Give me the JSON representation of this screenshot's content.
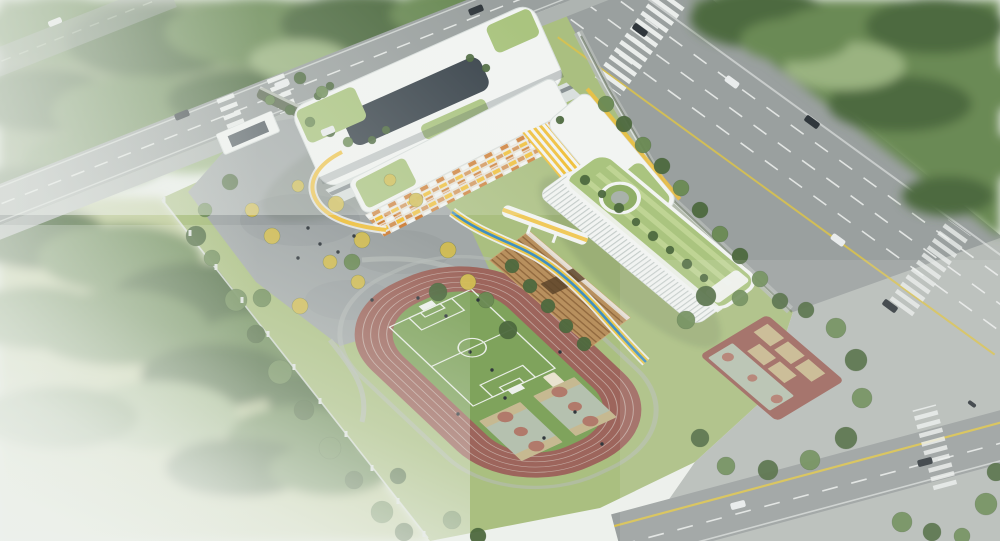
{
  "meta": {
    "title": "Aerial architectural rendering of a school campus",
    "image_type": "architectural bird's-eye render, no visible text",
    "regions": [
      "misty-forest-top-left",
      "urban-road-upper-left",
      "school-entrance-plaza-with-gate",
      "u-shaped-teaching-building",
      "classroom-slab-with-checkered-facade",
      "east-wing-yellow-louvers",
      "elevated-yellow-blue-walkway",
      "gymnasium-long-green-roof-with-circular-courtyard",
      "wood-grandstand-bleachers",
      "running-track-oval",
      "soccer-field",
      "basketball-courts-in-infield",
      "outdoor-courts-east",
      "main-arterial-road-right",
      "dense-forest-top-right",
      "foggy-forest-bottom-left",
      "intersection-and-pavement-bottom-right",
      "boundary-fence-with-posts"
    ]
  },
  "colors": {
    "mist": "#edf1ec",
    "forest_base": "#7b9465",
    "forest_dark": "#4e6a3f",
    "forest_mid": "#6b8a54",
    "forest_light": "#9ab380",
    "lawn": "#aabf80",
    "lawn_light": "#c3cf9e",
    "road": "#9aa09f",
    "pavement": "#b7bcb8",
    "sidewalk": "#aeb4b1",
    "lane_white": "#eef1ef",
    "lane_yellow": "#d8c14e",
    "plaza": "#a2a8a8",
    "plaza_dark": "#8b9294",
    "bldg_white": "#f2f4f2",
    "bldg_shade": "#d9dfdd",
    "bldg_dark": "#39434b",
    "accent_yellow": "#f0c13f",
    "accent_orange": "#d08440",
    "roof_green": "#8fae66",
    "roof_green_light": "#aac47f",
    "roof_stripe": "#bfd494",
    "track_red": "#9d655c",
    "track_line": "#d9cfc6",
    "field_green": "#7fa35c",
    "pitch_line": "#e9eee6",
    "court_gray": "#b5c1af",
    "court_terra": "#b17a6b",
    "court_tan": "#c8b88e",
    "bleacher": "#b8905e",
    "bleacher_line": "#8a6238",
    "ribbon_blue": "#3f8fc2",
    "ribbon_yellow": "#e9c64a",
    "tree_yellow": "#d2bd52",
    "car_dark": "#30373c",
    "car_white": "#e9ecec",
    "fence": "#dfe4e1",
    "hedge": "#5f6b55",
    "shed": "#e9e3cf",
    "shadow": "#4f5e49"
  },
  "scene": {
    "tree_legend": {
      "d": "forest_dark",
      "m": "forest_mid",
      "l": "forest_light",
      "y": "tree_yellow"
    },
    "trees": [
      [
        196,
        236,
        10,
        "d"
      ],
      [
        212,
        258,
        8,
        "m"
      ],
      [
        236,
        300,
        11,
        "m"
      ],
      [
        256,
        334,
        9,
        "d"
      ],
      [
        280,
        372,
        12,
        "m"
      ],
      [
        304,
        410,
        10,
        "d"
      ],
      [
        330,
        448,
        11,
        "m"
      ],
      [
        354,
        480,
        9,
        "d"
      ],
      [
        382,
        512,
        11,
        "m"
      ],
      [
        404,
        532,
        9,
        "d"
      ],
      [
        252,
        210,
        7,
        "y"
      ],
      [
        272,
        236,
        8,
        "y"
      ],
      [
        298,
        186,
        6,
        "y"
      ],
      [
        336,
        204,
        8,
        "y"
      ],
      [
        362,
        240,
        8,
        "y"
      ],
      [
        330,
        262,
        7,
        "y"
      ],
      [
        390,
        180,
        6,
        "y"
      ],
      [
        416,
        200,
        7,
        "y"
      ],
      [
        448,
        250,
        8,
        "y"
      ],
      [
        468,
        282,
        8,
        "y"
      ],
      [
        358,
        282,
        7,
        "y"
      ],
      [
        300,
        306,
        8,
        "y"
      ],
      [
        230,
        182,
        8,
        "d"
      ],
      [
        262,
        298,
        9,
        "m"
      ],
      [
        438,
        292,
        9,
        "d"
      ],
      [
        486,
        300,
        8,
        "m"
      ],
      [
        508,
        330,
        9,
        "d"
      ],
      [
        205,
        210,
        7,
        "m"
      ],
      [
        352,
        262,
        8,
        "m"
      ],
      [
        606,
        104,
        8,
        "m"
      ],
      [
        624,
        124,
        8,
        "d"
      ],
      [
        643,
        145,
        8,
        "m"
      ],
      [
        662,
        166,
        8,
        "d"
      ],
      [
        681,
        188,
        8,
        "m"
      ],
      [
        700,
        210,
        8,
        "d"
      ],
      [
        720,
        234,
        8,
        "m"
      ],
      [
        740,
        256,
        8,
        "d"
      ],
      [
        760,
        279,
        8,
        "m"
      ],
      [
        780,
        301,
        8,
        "d"
      ],
      [
        706,
        296,
        10,
        "d"
      ],
      [
        686,
        320,
        9,
        "m"
      ],
      [
        836,
        328,
        10,
        "m"
      ],
      [
        856,
        360,
        11,
        "d"
      ],
      [
        862,
        398,
        10,
        "m"
      ],
      [
        846,
        438,
        11,
        "d"
      ],
      [
        810,
        460,
        10,
        "m"
      ],
      [
        768,
        470,
        10,
        "d"
      ],
      [
        726,
        466,
        9,
        "m"
      ],
      [
        700,
        438,
        9,
        "d"
      ],
      [
        740,
        298,
        8,
        "m"
      ],
      [
        806,
        310,
        8,
        "d"
      ],
      [
        452,
        520,
        9,
        "m"
      ],
      [
        398,
        476,
        8,
        "d"
      ],
      [
        478,
        536,
        8,
        "d"
      ],
      [
        902,
        522,
        10,
        "m"
      ],
      [
        932,
        532,
        9,
        "d"
      ],
      [
        986,
        504,
        11,
        "m"
      ],
      [
        996,
        472,
        9,
        "d"
      ],
      [
        962,
        536,
        8,
        "m"
      ],
      [
        585,
        180,
        5,
        "d"
      ],
      [
        602,
        194,
        4,
        "d"
      ],
      [
        619,
        208,
        5,
        "d"
      ],
      [
        636,
        222,
        4,
        "d"
      ],
      [
        653,
        236,
        5,
        "d"
      ],
      [
        670,
        250,
        4,
        "d"
      ],
      [
        687,
        264,
        5,
        "d"
      ],
      [
        704,
        278,
        4,
        "d"
      ],
      [
        318,
        96,
        4,
        "d"
      ],
      [
        330,
        86,
        4,
        "d"
      ],
      [
        470,
        58,
        4,
        "d"
      ],
      [
        486,
        68,
        4,
        "d"
      ],
      [
        372,
        140,
        4,
        "d"
      ],
      [
        386,
        130,
        4,
        "d"
      ],
      [
        560,
        120,
        4,
        "d"
      ],
      [
        512,
        266,
        7,
        "d"
      ],
      [
        530,
        286,
        7,
        "d"
      ],
      [
        548,
        306,
        7,
        "d"
      ],
      [
        566,
        326,
        7,
        "d"
      ],
      [
        584,
        344,
        7,
        "d"
      ],
      [
        270,
        100,
        5,
        "m"
      ],
      [
        290,
        110,
        5,
        "d"
      ],
      [
        310,
        122,
        5,
        "m"
      ],
      [
        330,
        132,
        5,
        "d"
      ],
      [
        348,
        142,
        5,
        "m"
      ],
      [
        300,
        78,
        6,
        "d"
      ],
      [
        322,
        92,
        6,
        "m"
      ]
    ],
    "car_legend": {
      "dk": "car_dark",
      "wt": "car_white"
    },
    "cars": [
      [
        182,
        115,
        -22,
        "dk",
        15,
        7
      ],
      [
        282,
        84,
        -22,
        "wt",
        15,
        7
      ],
      [
        328,
        131,
        -22,
        "wt",
        14,
        7
      ],
      [
        476,
        10,
        -22,
        "dk",
        15,
        7
      ],
      [
        55,
        22,
        -22,
        "wt",
        14,
        6
      ],
      [
        640,
        30,
        36,
        "dk",
        16,
        7
      ],
      [
        732,
        82,
        36,
        "wt",
        15,
        7
      ],
      [
        812,
        122,
        36,
        "dk",
        16,
        7
      ],
      [
        838,
        240,
        36,
        "wt",
        15,
        7
      ],
      [
        890,
        306,
        36,
        "dk",
        16,
        7
      ],
      [
        972,
        404,
        36,
        "dk",
        9,
        4
      ],
      [
        738,
        505,
        -15,
        "wt",
        15,
        7
      ],
      [
        925,
        462,
        -15,
        "dk",
        15,
        7
      ]
    ],
    "people": [
      [
        308,
        228
      ],
      [
        320,
        244
      ],
      [
        338,
        252
      ],
      [
        298,
        258
      ],
      [
        354,
        236
      ],
      [
        418,
        298
      ],
      [
        446,
        316
      ],
      [
        478,
        300
      ],
      [
        470,
        352
      ],
      [
        492,
        370
      ],
      [
        505,
        398
      ],
      [
        458,
        414
      ],
      [
        560,
        352
      ],
      [
        372,
        300
      ],
      [
        575,
        412
      ],
      [
        544,
        438
      ],
      [
        602,
        444
      ]
    ],
    "fence_posts": [
      [
        164,
        202
      ],
      [
        190,
        235
      ],
      [
        216,
        269
      ],
      [
        242,
        302
      ],
      [
        268,
        336
      ],
      [
        294,
        369
      ],
      [
        320,
        403
      ],
      [
        346,
        436
      ],
      [
        372,
        470
      ],
      [
        398,
        503
      ],
      [
        424,
        536
      ]
    ]
  }
}
